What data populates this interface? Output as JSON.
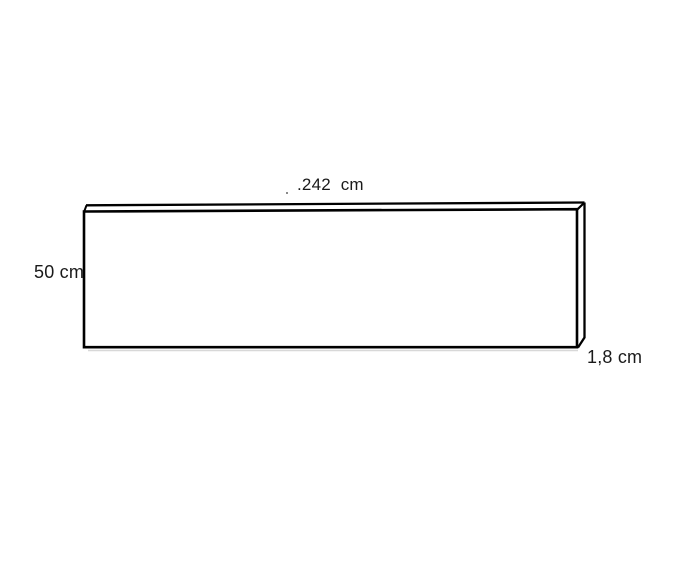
{
  "diagram": {
    "description": "Line drawing of a thin rectangular panel shown in slight 3D perspective with three dimension labels",
    "labels": {
      "width": ".242  cm",
      "height": "50 cm",
      "depth": "1,8 cm"
    },
    "dimensions": {
      "width_cm": 242,
      "height_cm": 50,
      "depth_cm": 1.8,
      "unit": "cm"
    },
    "colors": {
      "line": "#000000",
      "background": "#ffffff",
      "text": "#1a1a1a",
      "shadow": "#d8d8d8"
    }
  }
}
